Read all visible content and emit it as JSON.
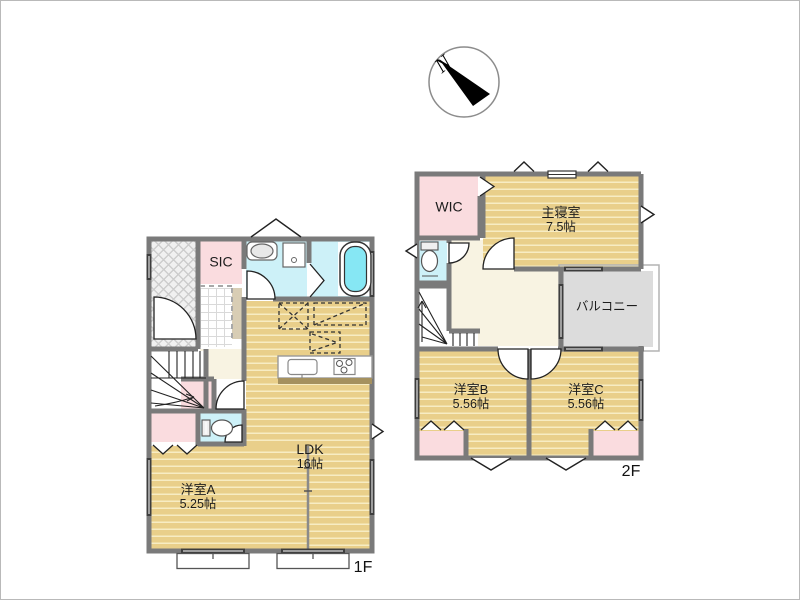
{
  "compass": {
    "north_label": "N"
  },
  "floor1": {
    "floor_label": "1F",
    "rooms": {
      "sic": {
        "name": "SIC"
      },
      "room_a": {
        "name": "洋室A",
        "size": "5.25帖"
      },
      "ldk": {
        "name": "LDK",
        "size": "16帖"
      }
    }
  },
  "floor2": {
    "floor_label": "2F",
    "rooms": {
      "wic": {
        "name": "WIC"
      },
      "master_bedroom": {
        "name": "主寝室",
        "size": "7.5帖"
      },
      "balcony": {
        "name": "バルコニー"
      },
      "room_b": {
        "name": "洋室B",
        "size": "5.56帖"
      },
      "room_c": {
        "name": "洋室C",
        "size": "5.56帖"
      }
    }
  },
  "colors": {
    "wall": "#7a7a7a",
    "wood_floor": "#e9cf8a",
    "closet_pink": "#fadcdf",
    "wet_area_cyan": "#cdf1f8",
    "bathtub_cyan": "#86e7f4",
    "hallway_beige": "#f8f3e2",
    "balcony_gray": "#dcdcdc"
  }
}
